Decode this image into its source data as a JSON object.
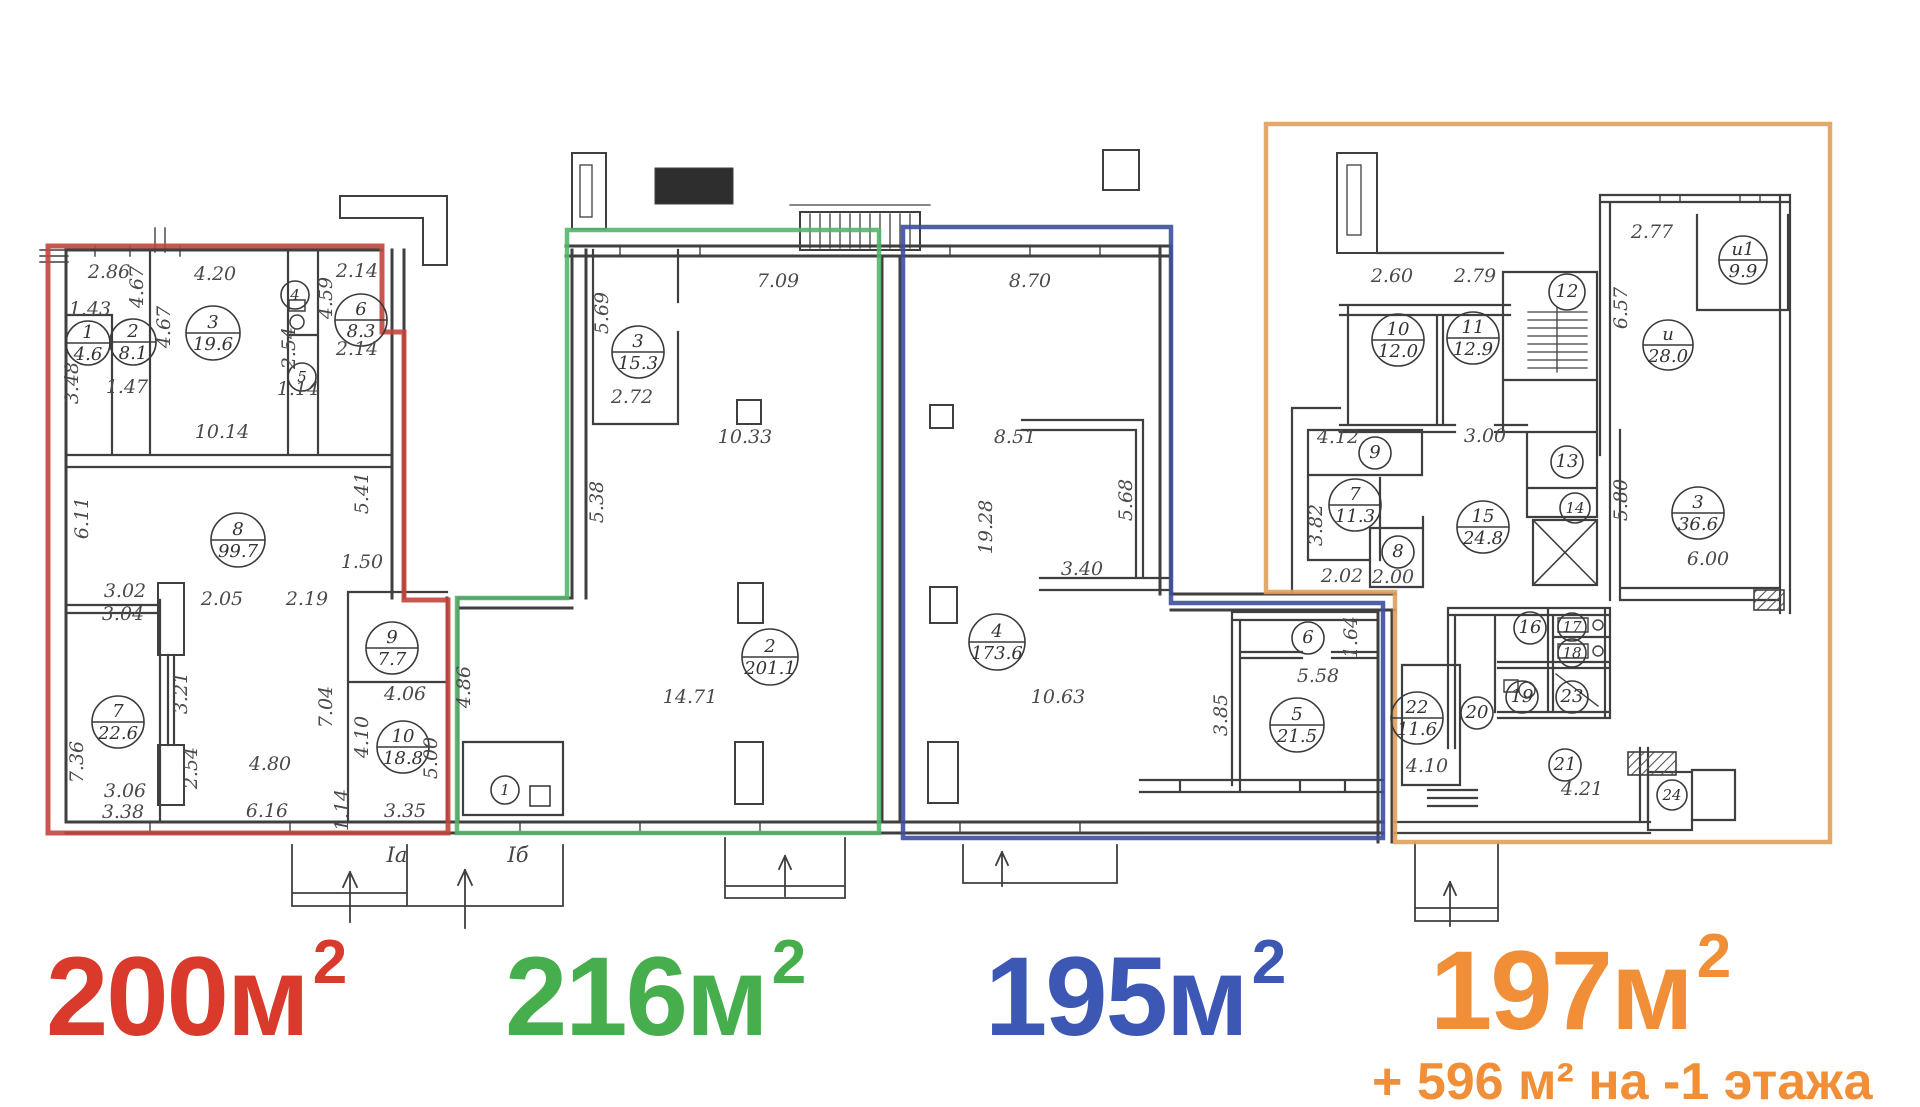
{
  "sections": [
    {
      "id": "red",
      "area_label": "200м",
      "area_sup": "2",
      "sub_label": "",
      "color": "#c2463c",
      "label_color": "#d93a2b"
    },
    {
      "id": "green",
      "area_label": "216м",
      "area_sup": "2",
      "sub_label": "",
      "color": "#58b56c",
      "label_color": "#47ae4d"
    },
    {
      "id": "blue",
      "area_label": "195м",
      "area_sup": "2",
      "sub_label": "",
      "color": "#3e4f9f",
      "label_color": "#3c57b4"
    },
    {
      "id": "orange",
      "area_label": "197м",
      "area_sup": "2",
      "sub_label": "+ 596 м² на -1 этажа",
      "color": "#e0a05c",
      "label_color": "#f08f37"
    }
  ],
  "rooms": [
    {
      "n": "1",
      "area": "4.6",
      "x": 88,
      "y": 343,
      "r": 22
    },
    {
      "n": "2",
      "area": "8.1",
      "x": 133,
      "y": 342,
      "r": 23
    },
    {
      "n": "3",
      "area": "19.6",
      "x": 213,
      "y": 333,
      "r": 27
    },
    {
      "n": "4",
      "x": 295,
      "y": 295,
      "r": 14
    },
    {
      "n": "5",
      "x": 302,
      "y": 377,
      "r": 14
    },
    {
      "n": "6",
      "area": "8.3",
      "x": 361,
      "y": 320,
      "r": 26
    },
    {
      "n": "7",
      "area": "22.6",
      "x": 118,
      "y": 722,
      "r": 26
    },
    {
      "n": "8",
      "area": "99.7",
      "x": 238,
      "y": 540,
      "r": 27
    },
    {
      "n": "9",
      "area": "7.7",
      "x": 392,
      "y": 648,
      "r": 26
    },
    {
      "n": "10",
      "area": "18.8",
      "x": 403,
      "y": 747,
      "r": 26
    },
    {
      "n": "3",
      "area": "15.3",
      "x": 638,
      "y": 352,
      "r": 26
    },
    {
      "n": "2",
      "area": "201.1",
      "x": 770,
      "y": 657,
      "r": 28
    },
    {
      "n": "1",
      "x": 505,
      "y": 790,
      "r": 14
    },
    {
      "n": "4",
      "area": "173.6",
      "x": 997,
      "y": 642,
      "r": 28
    },
    {
      "n": "6",
      "x": 1308,
      "y": 638,
      "r": 16
    },
    {
      "n": "5",
      "area": "21.5",
      "x": 1297,
      "y": 725,
      "r": 27
    },
    {
      "n": "10",
      "area": "12.0",
      "x": 1398,
      "y": 340,
      "r": 26
    },
    {
      "n": "11",
      "area": "12.9",
      "x": 1473,
      "y": 338,
      "r": 26
    },
    {
      "n": "12",
      "x": 1567,
      "y": 292,
      "r": 18
    },
    {
      "n": "и1",
      "area": "9.9",
      "x": 1743,
      "y": 260,
      "r": 24
    },
    {
      "n": "и",
      "area": "28.0",
      "x": 1668,
      "y": 345,
      "r": 25
    },
    {
      "n": "9",
      "x": 1375,
      "y": 453,
      "r": 16
    },
    {
      "n": "7",
      "area": "11.3",
      "x": 1355,
      "y": 505,
      "r": 26
    },
    {
      "n": "8",
      "x": 1398,
      "y": 552,
      "r": 16
    },
    {
      "n": "13",
      "x": 1567,
      "y": 462,
      "r": 16
    },
    {
      "n": "14",
      "x": 1575,
      "y": 508,
      "r": 15
    },
    {
      "n": "15",
      "area": "24.8",
      "x": 1483,
      "y": 527,
      "r": 26
    },
    {
      "n": "3",
      "area": "36.6",
      "x": 1698,
      "y": 513,
      "r": 26
    },
    {
      "n": "16",
      "x": 1530,
      "y": 628,
      "r": 16
    },
    {
      "n": "17",
      "x": 1572,
      "y": 627,
      "r": 14
    },
    {
      "n": "18",
      "x": 1572,
      "y": 653,
      "r": 14
    },
    {
      "n": "19",
      "x": 1522,
      "y": 697,
      "r": 16
    },
    {
      "n": "23",
      "x": 1572,
      "y": 697,
      "r": 16
    },
    {
      "n": "20",
      "x": 1477,
      "y": 713,
      "r": 16
    },
    {
      "n": "22",
      "area": "11.6",
      "x": 1417,
      "y": 718,
      "r": 26
    },
    {
      "n": "21",
      "x": 1565,
      "y": 765,
      "r": 16
    },
    {
      "n": "24",
      "x": 1672,
      "y": 795,
      "r": 15
    }
  ],
  "dimensions": [
    {
      "t": "2.86",
      "x": 109,
      "y": 278
    },
    {
      "t": "4.67",
      "x": 143,
      "y": 287,
      "rot": 1
    },
    {
      "t": "4.20",
      "x": 215,
      "y": 280
    },
    {
      "t": "2.14",
      "x": 357,
      "y": 277
    },
    {
      "t": "4.59",
      "x": 332,
      "y": 298,
      "rot": 1
    },
    {
      "t": "2.14",
      "x": 357,
      "y": 355
    },
    {
      "t": "1.43",
      "x": 90,
      "y": 315
    },
    {
      "t": "4.67",
      "x": 170,
      "y": 327,
      "rot": 1
    },
    {
      "t": "2.54",
      "x": 295,
      "y": 348,
      "rot": 1
    },
    {
      "t": "1.14",
      "x": 298,
      "y": 395
    },
    {
      "t": "3.48",
      "x": 78,
      "y": 383,
      "rot": 1
    },
    {
      "t": "1.47",
      "x": 127,
      "y": 393
    },
    {
      "t": "10.14",
      "x": 222,
      "y": 438
    },
    {
      "t": "5.41",
      "x": 368,
      "y": 493,
      "rot": 1
    },
    {
      "t": "6.11",
      "x": 88,
      "y": 518,
      "rot": 1
    },
    {
      "t": "1.50",
      "x": 362,
      "y": 568
    },
    {
      "t": "3.02",
      "x": 125,
      "y": 597
    },
    {
      "t": "3.04",
      "x": 123,
      "y": 620
    },
    {
      "t": "2.05",
      "x": 222,
      "y": 605
    },
    {
      "t": "2.19",
      "x": 307,
      "y": 605
    },
    {
      "t": "3.21",
      "x": 187,
      "y": 693,
      "rot": 1
    },
    {
      "t": "7.04",
      "x": 332,
      "y": 707,
      "rot": 1
    },
    {
      "t": "4.06",
      "x": 405,
      "y": 700
    },
    {
      "t": "4.10",
      "x": 368,
      "y": 737,
      "rot": 1
    },
    {
      "t": "5.00",
      "x": 437,
      "y": 758,
      "rot": 1
    },
    {
      "t": "7.36",
      "x": 83,
      "y": 762,
      "rot": 1
    },
    {
      "t": "2.54",
      "x": 197,
      "y": 768,
      "rot": 1
    },
    {
      "t": "4.80",
      "x": 270,
      "y": 770
    },
    {
      "t": "3.06",
      "x": 125,
      "y": 797
    },
    {
      "t": "3.38",
      "x": 123,
      "y": 818
    },
    {
      "t": "6.16",
      "x": 267,
      "y": 817
    },
    {
      "t": "1.14",
      "x": 348,
      "y": 810,
      "rot": 1
    },
    {
      "t": "3.35",
      "x": 405,
      "y": 817
    },
    {
      "t": "5.69",
      "x": 608,
      "y": 313,
      "rot": 1
    },
    {
      "t": "7.09",
      "x": 778,
      "y": 287
    },
    {
      "t": "2.72",
      "x": 632,
      "y": 403
    },
    {
      "t": "10.33",
      "x": 745,
      "y": 443
    },
    {
      "t": "5.38",
      "x": 603,
      "y": 502,
      "rot": 1
    },
    {
      "t": "14.71",
      "x": 690,
      "y": 703
    },
    {
      "t": "4.86",
      "x": 470,
      "y": 687,
      "rot": 1
    },
    {
      "t": "8.70",
      "x": 1030,
      "y": 287
    },
    {
      "t": "8.51",
      "x": 1015,
      "y": 443
    },
    {
      "t": "5.68",
      "x": 1132,
      "y": 500,
      "rot": 1
    },
    {
      "t": "19.28",
      "x": 992,
      "y": 527,
      "rot": 1
    },
    {
      "t": "3.40",
      "x": 1082,
      "y": 575
    },
    {
      "t": "10.63",
      "x": 1058,
      "y": 703
    },
    {
      "t": "1.64",
      "x": 1357,
      "y": 637,
      "rot": 1
    },
    {
      "t": "5.58",
      "x": 1318,
      "y": 682
    },
    {
      "t": "3.85",
      "x": 1227,
      "y": 715,
      "rot": 1
    },
    {
      "t": "2.60",
      "x": 1392,
      "y": 282
    },
    {
      "t": "2.79",
      "x": 1475,
      "y": 282
    },
    {
      "t": "2.77",
      "x": 1652,
      "y": 238
    },
    {
      "t": "6.57",
      "x": 1627,
      "y": 308,
      "rot": 1
    },
    {
      "t": "4.12",
      "x": 1338,
      "y": 443
    },
    {
      "t": "3.82",
      "x": 1322,
      "y": 525,
      "rot": 1
    },
    {
      "t": "2.02",
      "x": 1342,
      "y": 582
    },
    {
      "t": "2.00",
      "x": 1393,
      "y": 583
    },
    {
      "t": "3.00",
      "x": 1485,
      "y": 442
    },
    {
      "t": "5.80",
      "x": 1627,
      "y": 500,
      "rot": 1
    },
    {
      "t": "6.00",
      "x": 1708,
      "y": 565
    },
    {
      "t": "4.10",
      "x": 1427,
      "y": 772
    },
    {
      "t": "4.21",
      "x": 1582,
      "y": 795
    }
  ],
  "entries": [
    {
      "label": "Iа",
      "x": 397,
      "y": 862
    },
    {
      "label": "Iб",
      "x": 518,
      "y": 862
    }
  ]
}
